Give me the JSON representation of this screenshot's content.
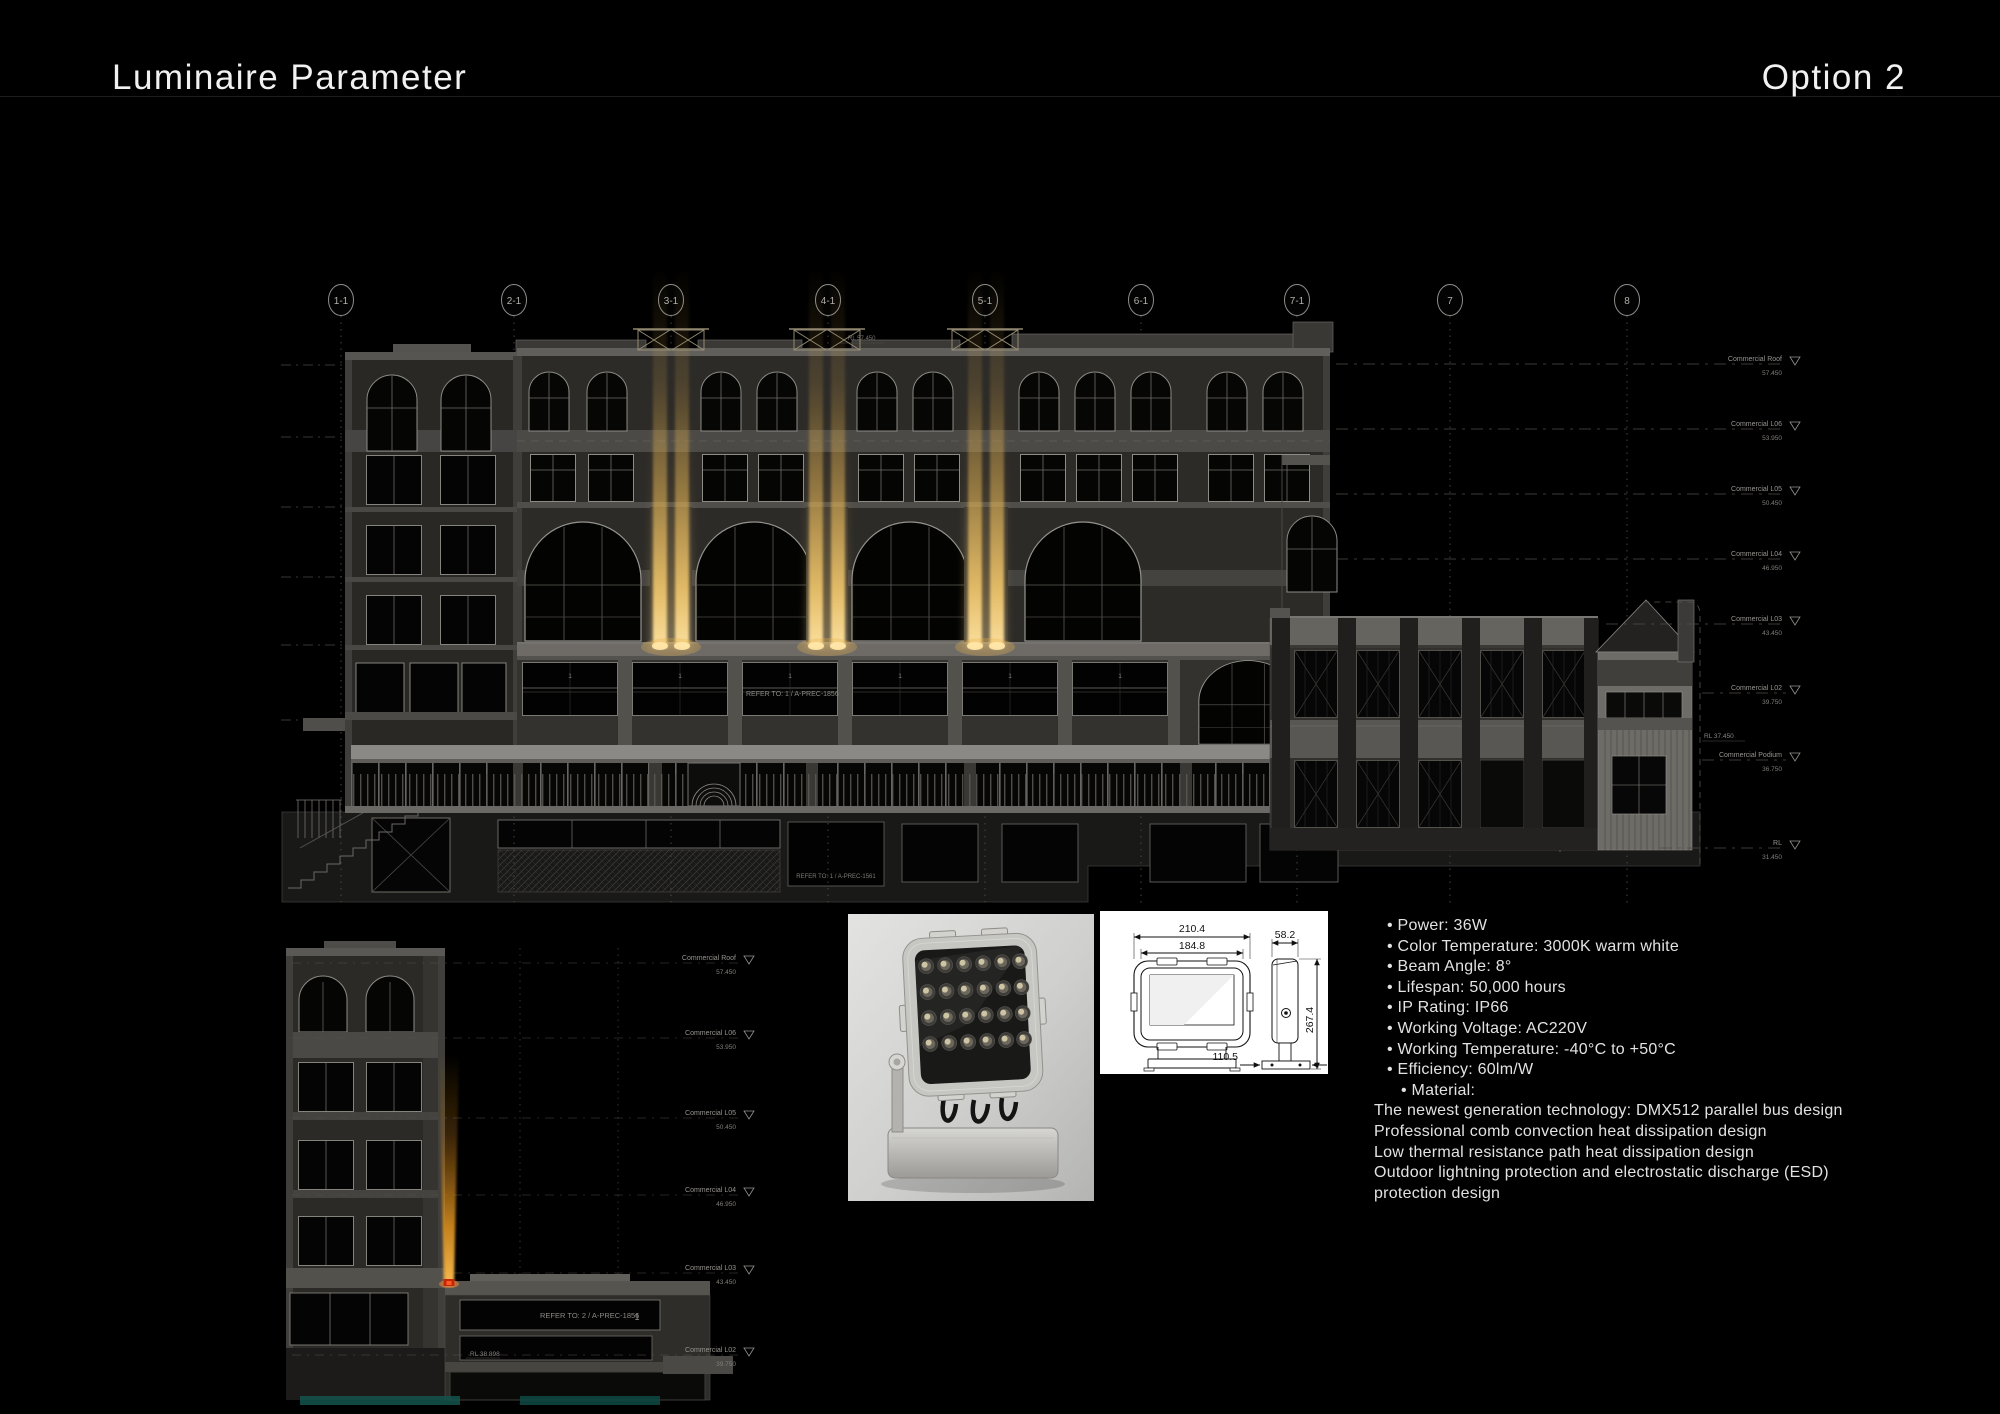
{
  "header": {
    "title": "Luminaire Parameter",
    "option": "Option 2"
  },
  "grid": {
    "bubbles": [
      "1-1",
      "2-1",
      "3-1",
      "4-1",
      "5-1",
      "6-1",
      "7-1",
      "7",
      "8"
    ]
  },
  "levels": [
    {
      "label": "Commercial Roof",
      "rl": "57.450"
    },
    {
      "label": "Commercial L06",
      "rl": "53.950"
    },
    {
      "label": "Commercial L05",
      "rl": "50.450"
    },
    {
      "label": "Commercial L04",
      "rl": "46.950"
    },
    {
      "label": "Commercial L03",
      "rl": "43.450"
    },
    {
      "label": "Commercial L02",
      "rl": "39.750"
    },
    {
      "label": "Commercial Podium",
      "rl": "36.750"
    },
    {
      "label": "RL",
      "rl": "31.450"
    }
  ],
  "annotations": {
    "rl_roof": "RL 57.450",
    "rl_podium": "RL 37.450",
    "rl_annex": "RL 38.898",
    "podium_refer": "REFER TO: 1 / A-PREC-1856",
    "base_refer": "REFER TO: 1 / A-PREC-1561",
    "section_refer": "REFER TO: 2 / A-PREC-1856",
    "type_tag": "1"
  },
  "dimensions": {
    "outer_width": "210.4",
    "inner_width": "184.8",
    "side_width": "58.2",
    "height": "267.4",
    "base_width": "110.5"
  },
  "specs": {
    "bullets": [
      "• Power: 36W",
      "• Color Temperature: 3000K warm white",
      "• Beam Angle: 8°",
      "• Lifespan: 50,000 hours",
      "• IP Rating: IP66",
      "• Working Voltage: AC220V",
      "• Working Temperature: -40°C to +50°C",
      "• Efficiency: 60lm/W"
    ],
    "material": "• Material:",
    "notes": [
      "The newest generation technology: DMX512 parallel bus design",
      "Professional comb convection heat dissipation design",
      "Low thermal resistance path heat dissipation design",
      "Outdoor lightning protection and electrostatic discharge (ESD)",
      "protection design"
    ]
  },
  "colors": {
    "beam": "#e8b44e",
    "beam_bright": "#ffe3a0",
    "fixture_red": "#c22708",
    "accent_teal": "#14544c"
  }
}
